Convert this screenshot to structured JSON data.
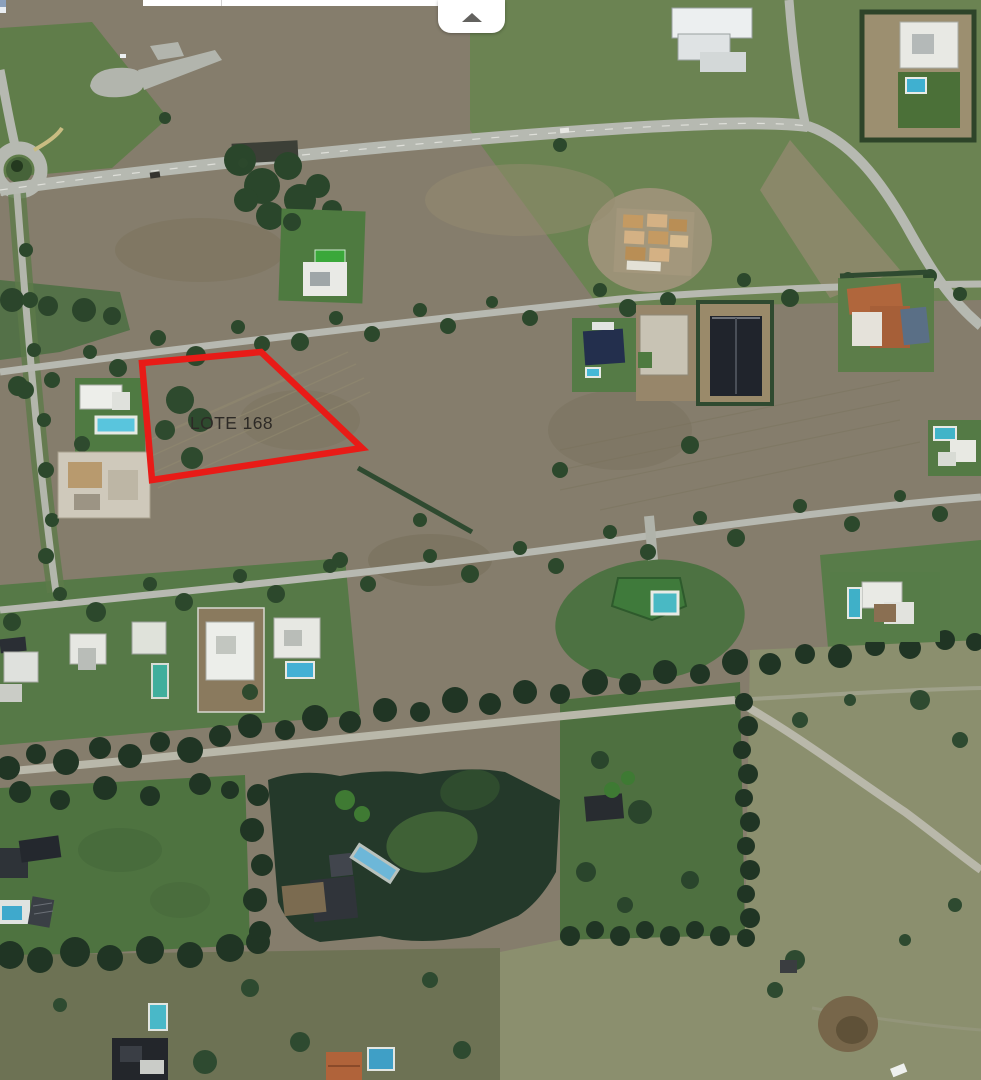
{
  "header": {
    "collapse_button": {
      "icon": "chevron-up-icon"
    }
  },
  "map": {
    "view": "satellite",
    "overlay": {
      "label": "LOTE 168",
      "label_color": "#2d2a26",
      "polygon_points": "142,363 261,352 362,448 152,480",
      "polygon_color": "#e81b17"
    }
  }
}
